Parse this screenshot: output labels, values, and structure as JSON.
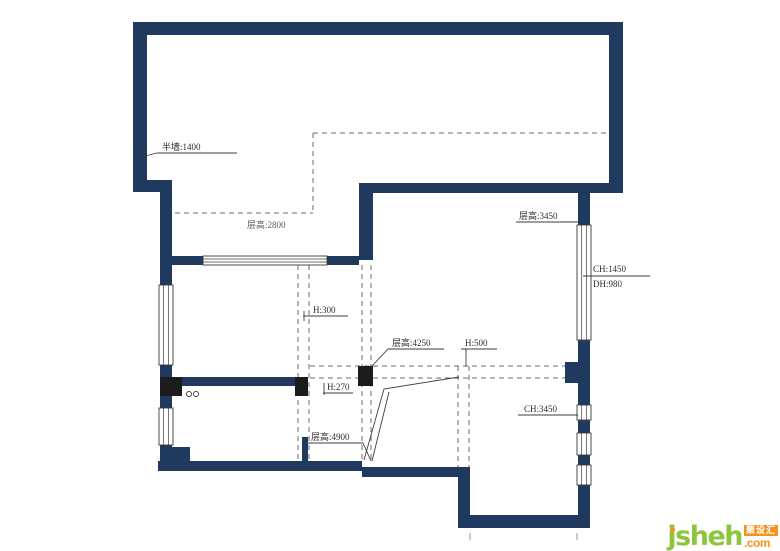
{
  "title": "apartment-floor-plan",
  "colors": {
    "wall": "#1f3a5e",
    "column": "#1c1c1c",
    "window_stroke": "#3b3b3b",
    "dash": "#6e6e6e",
    "line": "#3c3c3c",
    "label": "#2e2e2e",
    "label_gray": "#5a5a5a",
    "logo_green": "#8cc63e",
    "logo_orange": "#f6921e"
  },
  "walls": [
    {
      "x": 133,
      "y": 22,
      "w": 490,
      "h": 13
    },
    {
      "x": 133,
      "y": 22,
      "w": 14,
      "h": 170
    },
    {
      "x": 133,
      "y": 180,
      "w": 39,
      "h": 12
    },
    {
      "x": 609,
      "y": 22,
      "w": 14,
      "h": 171
    },
    {
      "x": 359,
      "y": 183,
      "w": 264,
      "h": 10
    },
    {
      "x": 359,
      "y": 183,
      "w": 14,
      "h": 77
    },
    {
      "x": 160,
      "y": 183,
      "w": 12,
      "h": 287
    },
    {
      "x": 172,
      "y": 256,
      "w": 187,
      "h": 9
    },
    {
      "x": 578,
      "y": 193,
      "w": 12,
      "h": 335
    },
    {
      "x": 172,
      "y": 377,
      "w": 126,
      "h": 9
    },
    {
      "x": 158,
      "y": 461,
      "w": 204,
      "h": 10
    },
    {
      "x": 170,
      "y": 447,
      "w": 20,
      "h": 15
    },
    {
      "x": 302,
      "y": 437,
      "w": 6,
      "h": 25
    },
    {
      "x": 362,
      "y": 467,
      "w": 108,
      "h": 10
    },
    {
      "x": 458,
      "y": 467,
      "w": 12,
      "h": 61
    },
    {
      "x": 458,
      "y": 515,
      "w": 132,
      "h": 13
    },
    {
      "x": 565,
      "y": 362,
      "w": 13,
      "h": 21
    }
  ],
  "columns": [
    {
      "x": 160,
      "y": 377,
      "w": 22,
      "h": 19
    },
    {
      "x": 295,
      "y": 377,
      "w": 13,
      "h": 19
    },
    {
      "x": 358,
      "y": 366,
      "w": 15,
      "h": 20
    }
  ],
  "windows": [
    {
      "x": 159,
      "y": 285,
      "w": 14,
      "h": 80,
      "o": "v"
    },
    {
      "x": 159,
      "y": 408,
      "w": 14,
      "h": 37,
      "o": "v"
    },
    {
      "x": 577,
      "y": 225,
      "w": 14,
      "h": 115,
      "o": "v"
    },
    {
      "x": 577,
      "y": 405,
      "w": 14,
      "h": 15,
      "o": "v"
    },
    {
      "x": 577,
      "y": 433,
      "w": 14,
      "h": 22,
      "o": "v"
    },
    {
      "x": 577,
      "y": 465,
      "w": 14,
      "h": 20,
      "o": "v"
    },
    {
      "x": 203,
      "y": 256,
      "w": 124,
      "h": 9,
      "o": "h"
    }
  ],
  "dashes": [
    [
      313,
      133,
      615,
      133
    ],
    [
      313,
      133,
      313,
      213
    ],
    [
      175,
      213,
      313,
      213
    ],
    [
      298,
      265,
      298,
      461
    ],
    [
      309,
      265,
      309,
      461
    ],
    [
      362,
      265,
      362,
      460
    ],
    [
      371,
      265,
      371,
      460
    ],
    [
      458,
      366,
      458,
      467
    ],
    [
      469,
      366,
      469,
      467
    ],
    [
      310,
      366,
      578,
      366
    ],
    [
      310,
      378,
      578,
      378
    ]
  ],
  "diagonals": [
    [
      [
        459,
        377
      ],
      [
        384,
        389
      ],
      [
        364,
        460
      ]
    ],
    [
      [
        389,
        392
      ],
      [
        372,
        461
      ]
    ]
  ],
  "circles": [
    {
      "cx": 189,
      "cy": 394,
      "r": 2.5
    },
    {
      "cx": 196,
      "cy": 394,
      "r": 2.5
    }
  ],
  "ticks": [
    [
      470,
      533,
      470,
      540
    ],
    [
      577,
      533,
      577,
      540
    ]
  ],
  "labels": [
    {
      "text": "半墙:1400",
      "x": 162,
      "y": 150,
      "ul": [
        157,
        153,
        237,
        153
      ],
      "leader": [
        [
          137,
          158
        ],
        [
          157,
          153
        ]
      ]
    },
    {
      "text": "层高:2800",
      "x": 247,
      "y": 228,
      "gray": true
    },
    {
      "text": "层高:3450",
      "x": 519,
      "y": 219,
      "ul": [
        516,
        222,
        578,
        222
      ]
    },
    {
      "text": "CH:1450",
      "x": 593,
      "y": 272,
      "ul": [
        583,
        276,
        650,
        276
      ]
    },
    {
      "text": "DH:980",
      "x": 593,
      "y": 287
    },
    {
      "text": "H:300",
      "x": 313,
      "y": 313,
      "ul": [
        303,
        316,
        348,
        316
      ],
      "tick": [
        304,
        311,
        304,
        321
      ]
    },
    {
      "text": "层高:4250",
      "x": 392,
      "y": 346,
      "ul": [
        388,
        349,
        444,
        349
      ],
      "leader": [
        [
          388,
          349
        ],
        [
          371,
          367
        ]
      ]
    },
    {
      "text": "H:500",
      "x": 465,
      "y": 346,
      "ul": [
        461,
        349,
        497,
        349
      ],
      "leader": [
        [
          466,
          349
        ],
        [
          466,
          366
        ]
      ]
    },
    {
      "text": "H:270",
      "x": 327,
      "y": 390,
      "ul": [
        323,
        393,
        353,
        393
      ],
      "tick": [
        324,
        383,
        324,
        395
      ]
    },
    {
      "text": "层高:4900",
      "x": 311,
      "y": 440,
      "ul": [
        307,
        443,
        363,
        443
      ],
      "leader": [
        [
          363,
          443
        ],
        [
          371,
          461
        ]
      ]
    },
    {
      "text": "CH:3450",
      "x": 524,
      "y": 412,
      "ul": [
        518,
        415,
        578,
        415
      ]
    }
  ],
  "logo": {
    "brand": "jsheh",
    "cn": "聚设汇",
    "tld": ".com"
  }
}
